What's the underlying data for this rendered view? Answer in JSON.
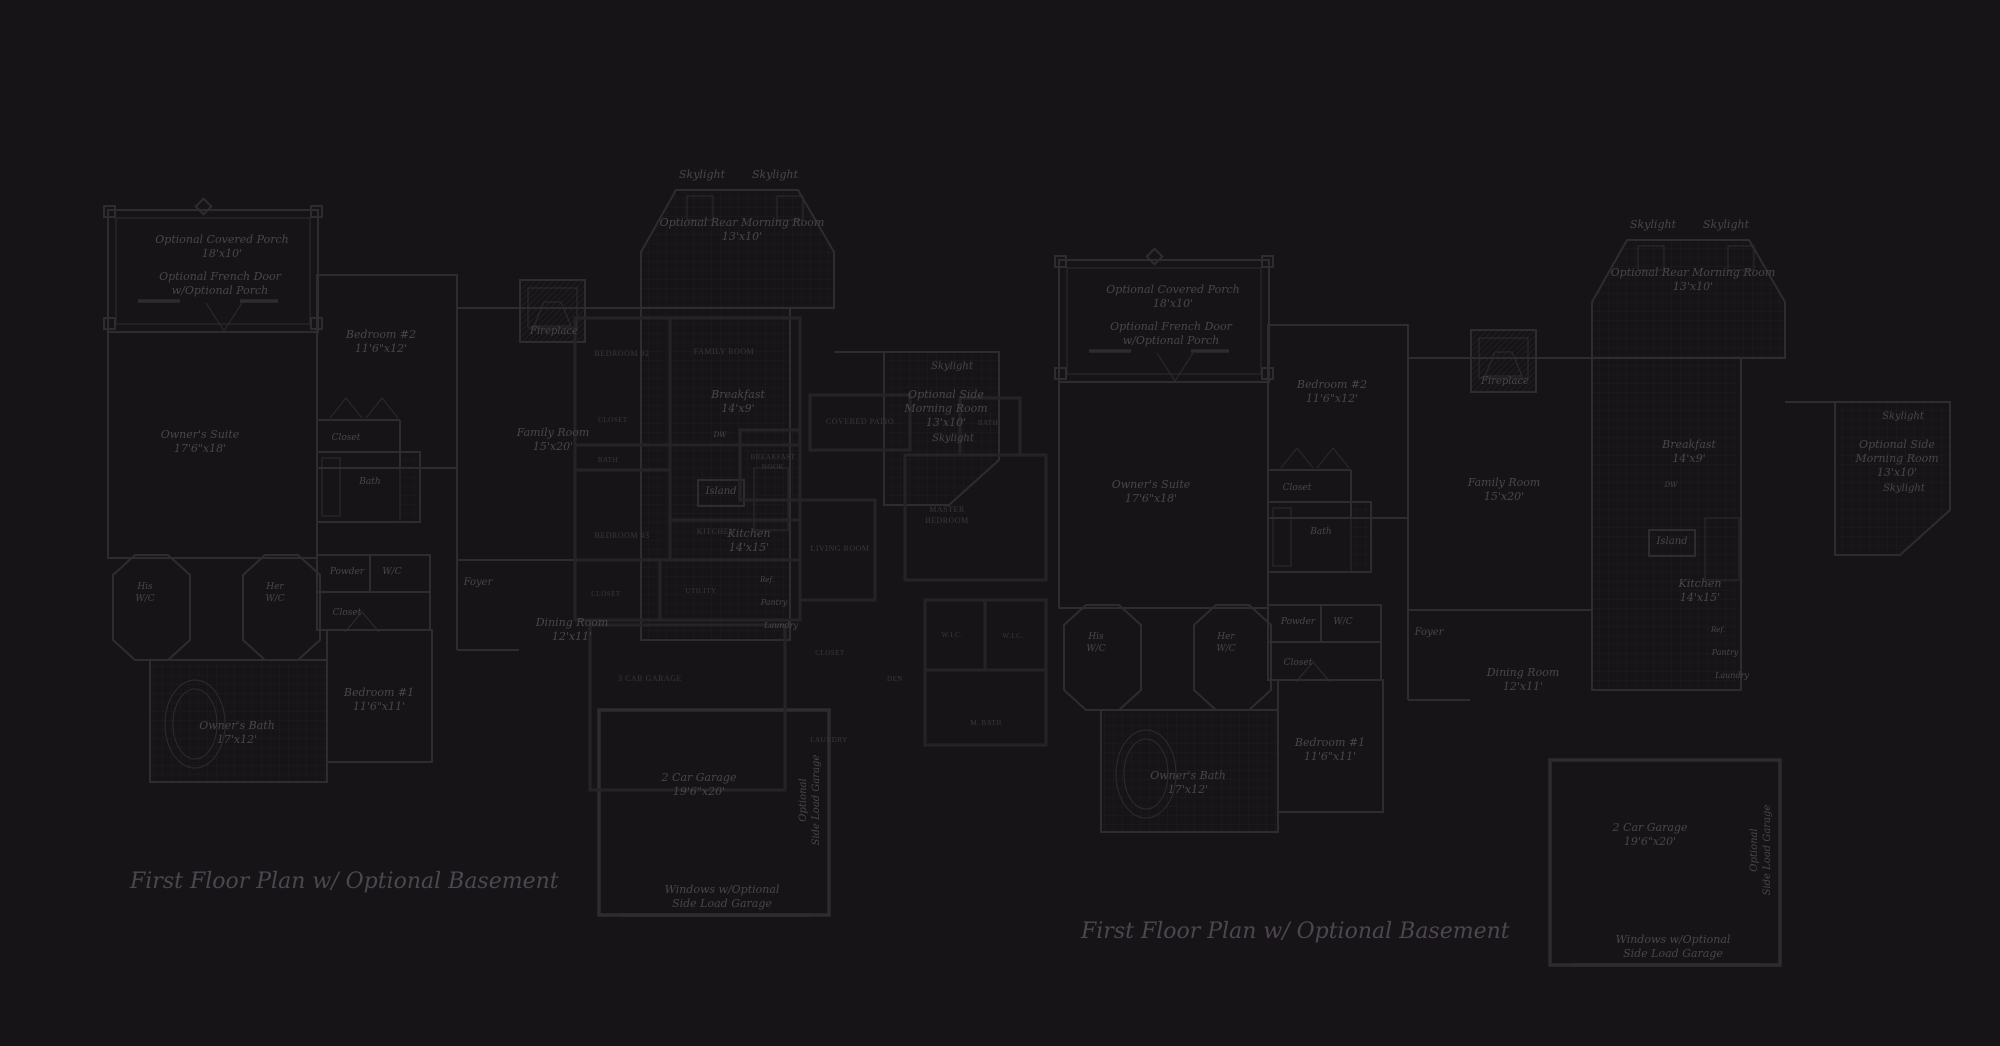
{
  "colors": {
    "background": "#171417",
    "wall_main": "#2f2b2f",
    "wall_overlay": "#262326",
    "tile_grid": "#201d20",
    "text_italic": "#4b454b",
    "text_caps": "#3b373b",
    "text_caption": "#4d4650"
  },
  "captions": {
    "left": "First Floor Plan  w/ Optional Basement",
    "right": "First Floor Plan  w/ Optional Basement"
  },
  "main_plan": {
    "name": "first-floor-plan",
    "right_copy_offset": [
      951,
      50
    ],
    "labels": [
      {
        "x": 222,
        "y": 243,
        "size": 11,
        "lines": [
          "Optional Covered Porch",
          "18'x10'"
        ]
      },
      {
        "x": 220,
        "y": 280,
        "size": 11,
        "lines": [
          "Optional French Door",
          "w/Optional Porch"
        ]
      },
      {
        "x": 381,
        "y": 338,
        "size": 11,
        "lines": [
          "Bedroom #2",
          "11'6\"x12'"
        ]
      },
      {
        "x": 200,
        "y": 438,
        "size": 11,
        "lines": [
          "Owner's Suite",
          "17'6\"x18'"
        ]
      },
      {
        "x": 346,
        "y": 440,
        "size": 9,
        "lines": [
          "Closet"
        ]
      },
      {
        "x": 370,
        "y": 484,
        "size": 9,
        "lines": [
          "Bath"
        ]
      },
      {
        "x": 554,
        "y": 334,
        "size": 10,
        "lines": [
          "Fireplace"
        ]
      },
      {
        "x": 702,
        "y": 178,
        "size": 11,
        "lines": [
          "Skylight"
        ]
      },
      {
        "x": 775,
        "y": 178,
        "size": 11,
        "lines": [
          "Skylight"
        ]
      },
      {
        "x": 742,
        "y": 226,
        "size": 11,
        "lines": [
          "Optional Rear Morning Room",
          "13'x10'"
        ]
      },
      {
        "x": 553,
        "y": 436,
        "size": 11,
        "lines": [
          "Family Room",
          "15'x20'"
        ]
      },
      {
        "x": 145,
        "y": 589,
        "size": 9,
        "lines": [
          "His",
          "W/C"
        ]
      },
      {
        "x": 275,
        "y": 589,
        "size": 9,
        "lines": [
          "Her",
          "W/C"
        ]
      },
      {
        "x": 347,
        "y": 574,
        "size": 9,
        "lines": [
          "Powder"
        ]
      },
      {
        "x": 392,
        "y": 574,
        "size": 9,
        "lines": [
          "W/C"
        ]
      },
      {
        "x": 347,
        "y": 615,
        "size": 9,
        "lines": [
          "Closet"
        ]
      },
      {
        "x": 478,
        "y": 585,
        "size": 10,
        "lines": [
          "Foyer"
        ]
      },
      {
        "x": 572,
        "y": 626,
        "size": 11,
        "lines": [
          "Dining Room",
          "12'x11'"
        ]
      },
      {
        "x": 379,
        "y": 696,
        "size": 11,
        "lines": [
          "Bedroom #1",
          "11'6\"x11'"
        ]
      },
      {
        "x": 237,
        "y": 729,
        "size": 11,
        "lines": [
          "Owner's Bath",
          "17'x12'"
        ]
      },
      {
        "x": 738,
        "y": 398,
        "size": 11,
        "lines": [
          "Breakfast",
          "14'x9'"
        ]
      },
      {
        "x": 720,
        "y": 437,
        "size": 7,
        "lines": [
          "DW"
        ]
      },
      {
        "x": 721,
        "y": 494,
        "size": 10,
        "lines": [
          "Island"
        ]
      },
      {
        "x": 749,
        "y": 537,
        "size": 11,
        "lines": [
          "Kitchen",
          "14'x15'"
        ]
      },
      {
        "x": 767,
        "y": 582,
        "size": 7,
        "lines": [
          "Ref."
        ]
      },
      {
        "x": 774,
        "y": 605,
        "size": 8,
        "lines": [
          "Pantry"
        ]
      },
      {
        "x": 781,
        "y": 628,
        "size": 8,
        "lines": [
          "Laundry"
        ]
      },
      {
        "x": 952,
        "y": 369,
        "size": 10,
        "lines": [
          "Skylight"
        ]
      },
      {
        "x": 946,
        "y": 398,
        "size": 11,
        "lines": [
          "Optional Side",
          "Morning Room",
          "13'x10'"
        ]
      },
      {
        "x": 953,
        "y": 441,
        "size": 10,
        "lines": [
          "Skylight"
        ]
      },
      {
        "x": 699,
        "y": 781,
        "size": 11,
        "lines": [
          "2 Car Garage",
          "19'6\"x20'"
        ]
      },
      {
        "x": 806,
        "y": 800,
        "size": 10,
        "rotate": -90,
        "lines": [
          "Optional",
          "Side Load Garage"
        ]
      },
      {
        "x": 722,
        "y": 893,
        "size": 11,
        "lines": [
          "Windows w/Optional",
          "Side Load Garage"
        ]
      }
    ]
  },
  "overlay_plan": {
    "name": "overlay-floor-plan",
    "labels": [
      {
        "x": 622,
        "y": 356,
        "size": 8,
        "lines": [
          "BEDROOM #2"
        ]
      },
      {
        "x": 724,
        "y": 354,
        "size": 8,
        "lines": [
          "FAMILY ROOM"
        ]
      },
      {
        "x": 613,
        "y": 422,
        "size": 7,
        "lines": [
          "CLOSET"
        ]
      },
      {
        "x": 608,
        "y": 462,
        "size": 7,
        "lines": [
          "BATH"
        ]
      },
      {
        "x": 773,
        "y": 459,
        "size": 7,
        "lines": [
          "BREAKFAST",
          "NOOK"
        ]
      },
      {
        "x": 622,
        "y": 538,
        "size": 8,
        "lines": [
          "BEDROOM #3"
        ]
      },
      {
        "x": 716,
        "y": 534,
        "size": 8,
        "lines": [
          "KITCHEN"
        ]
      },
      {
        "x": 840,
        "y": 551,
        "size": 8,
        "lines": [
          "LIVING ROOM"
        ]
      },
      {
        "x": 860,
        "y": 424,
        "size": 8,
        "lines": [
          "COVERED PATIO"
        ]
      },
      {
        "x": 947,
        "y": 512,
        "size": 8,
        "lines": [
          "MASTER",
          "BEDROOM"
        ]
      },
      {
        "x": 988,
        "y": 425,
        "size": 7,
        "lines": [
          "BATH"
        ]
      },
      {
        "x": 952,
        "y": 637,
        "size": 7,
        "lines": [
          "W.I.C."
        ]
      },
      {
        "x": 1013,
        "y": 638,
        "size": 7,
        "lines": [
          "W.I.C."
        ]
      },
      {
        "x": 895,
        "y": 681,
        "size": 7,
        "lines": [
          "DEN"
        ]
      },
      {
        "x": 986,
        "y": 725,
        "size": 7,
        "lines": [
          "M. BATH"
        ]
      },
      {
        "x": 830,
        "y": 655,
        "size": 7,
        "lines": [
          "CLOSET"
        ]
      },
      {
        "x": 829,
        "y": 742,
        "size": 7,
        "lines": [
          "LAUNDRY"
        ]
      },
      {
        "x": 606,
        "y": 596,
        "size": 7,
        "lines": [
          "CLOSET"
        ]
      },
      {
        "x": 701,
        "y": 593,
        "size": 7,
        "lines": [
          "UTILITY"
        ]
      },
      {
        "x": 650,
        "y": 681,
        "size": 8,
        "lines": [
          "3 CAR GARAGE"
        ]
      }
    ]
  }
}
